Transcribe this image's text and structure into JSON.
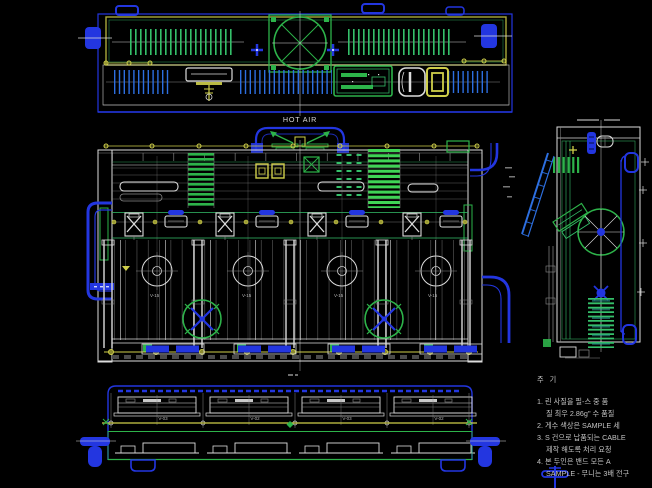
{
  "colors": {
    "background": "#000000",
    "blue": "#2336e0",
    "light_blue": "#2d6fe0",
    "green": "#2db34a",
    "bright_green": "#35c06a",
    "yellow": "#cfcf4a",
    "white": "#dcdcdc"
  },
  "labels": {
    "hot_air": "HOT AIR"
  },
  "front_view": {
    "bay_labels": [
      "V-15",
      "V-15",
      "V-15",
      "V-15"
    ]
  },
  "bottom_view": {
    "tray_labels": [
      "V-03",
      "V-02",
      "V-03",
      "V-02"
    ]
  },
  "notes": {
    "title": "주 기",
    "lines": [
      "1. 린 사질을 필-스 중 품",
      "질 최우 2.86g'' 수 품질",
      "2. 게수 색상은 SAMPLE 세",
      "3. S 건으로 납품되는 CABLE",
      "제작 해도록 처리 요청",
      "4. 본 두인은 밴드 모든 A",
      "SAMPLE - 무니는 3배 전구"
    ]
  }
}
